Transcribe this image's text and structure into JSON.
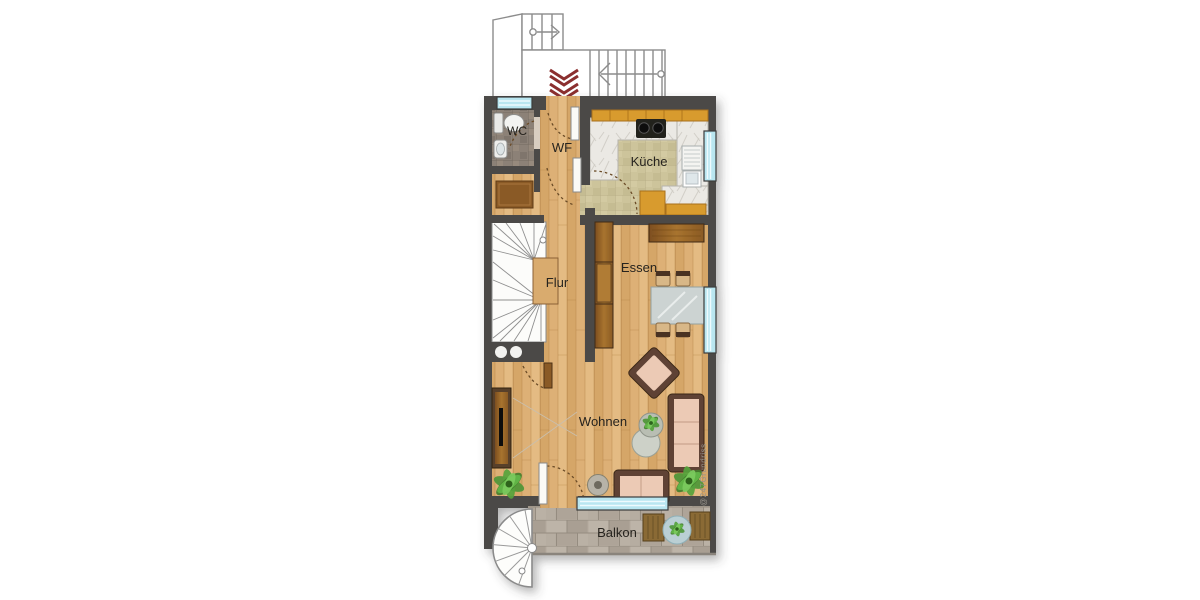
{
  "plan_type": "apartment-floor-plan",
  "rooms": {
    "wc": {
      "label": "WC"
    },
    "wf": {
      "label": "WF"
    },
    "kueche": {
      "label": "Küche"
    },
    "flur": {
      "label": "Flur"
    },
    "essen": {
      "label": "Essen"
    },
    "wohnen": {
      "label": "Wohnen"
    },
    "balkon": {
      "label": "Balkon"
    }
  },
  "watermark": {
    "text": "@247Grundriss"
  },
  "icons": {
    "entrance_arrow": "double-chevron-down-icon",
    "exterior_stairs": "staircase-icon",
    "interior_stairs": "winder-staircase-icon",
    "spiral_stairs": "spiral-staircase-icon",
    "toilet": "toilet-icon",
    "sink": "sink-icon",
    "stove": "cooktop-icon"
  },
  "colors": {
    "wall": "#4c4a47",
    "wood_floor": "#ddb076",
    "kitchen_tile": "#cdc49b",
    "wc_tile": "#8c8177",
    "balcony_stone": "#b2a99d",
    "window_glass": "#b9e6f0",
    "entrance_arrow_red": "#8b2f2f",
    "sofa_cushion": "#eccab5",
    "furniture_frame": "#5e4234",
    "cabinet_orange": "#d89b2f",
    "plant_green": "#55a33c"
  }
}
